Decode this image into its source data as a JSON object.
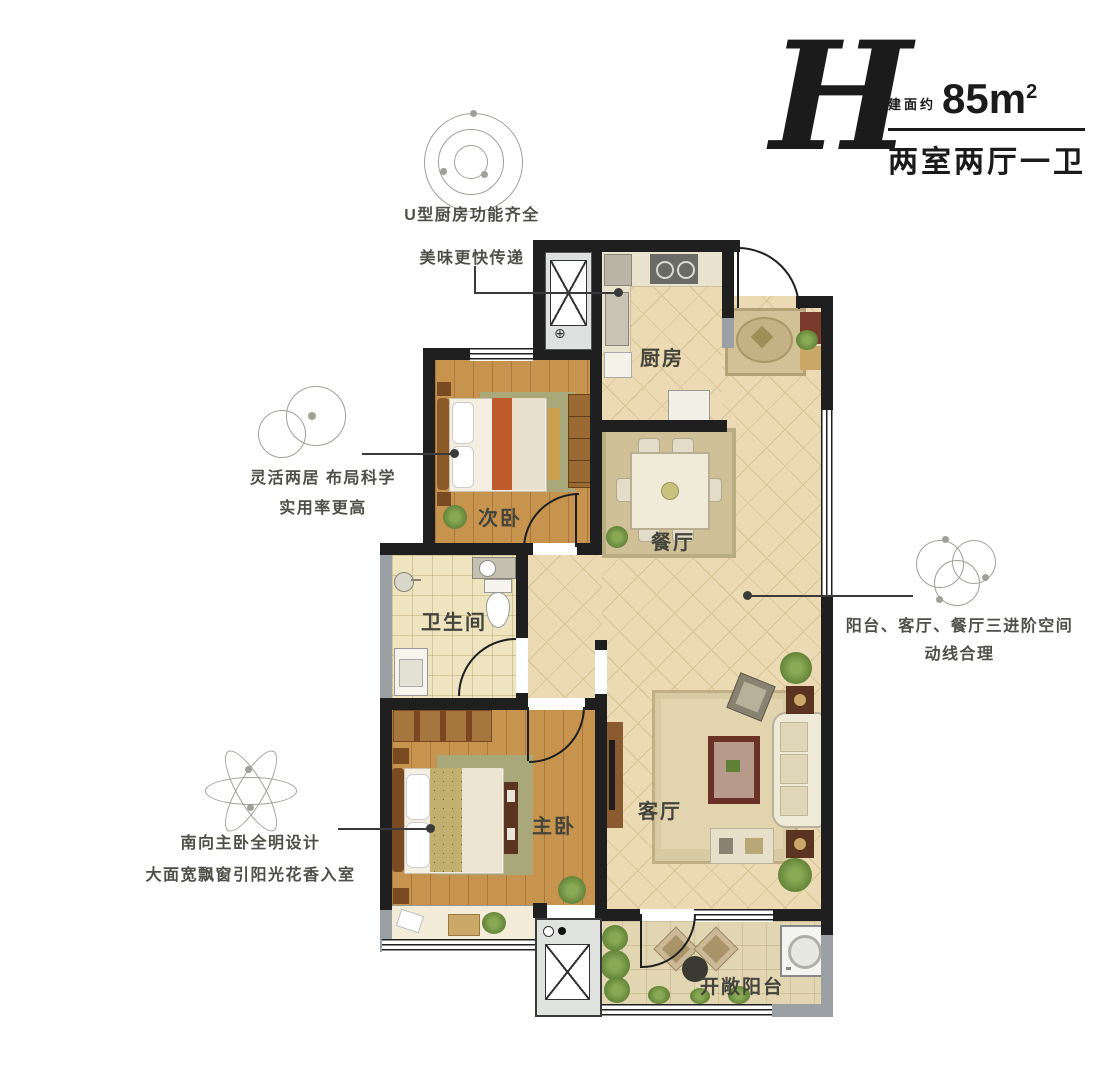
{
  "title_block": {
    "letter": "H",
    "area_prefix": "建面约",
    "area_value": "85m",
    "area_sup": "2",
    "layout_desc": "两室两厅一卫"
  },
  "annotations": {
    "kitchen": {
      "line1": "U型厨房功能齐全",
      "line2": "美味更快传递"
    },
    "flexible": {
      "line1": "灵活两居 布局科学",
      "line2": "实用率更高"
    },
    "flow": {
      "line1": "阳台、客厅、餐厅三进阶空间",
      "line2": "动线合理"
    },
    "master": {
      "line1": "南向主卧全明设计",
      "line2": "大面宽飘窗引阳光花香入室"
    }
  },
  "rooms": {
    "kitchen": "厨房",
    "second_bedroom": "次卧",
    "dining": "餐厅",
    "bathroom": "卫生间",
    "master_bedroom": "主卧",
    "living_room": "客厅",
    "balcony": "开敞阳台"
  },
  "icons": {
    "compass": "⊕"
  },
  "colors": {
    "wall": "#1f1f1f",
    "graywall": "#9aa0a3",
    "tile": "#ebdab3",
    "tileline": "#d8c495",
    "wood": "#c6944f",
    "bath": "#eee4bf",
    "balcony": "#e2d6b2",
    "rug": "#a9a87b",
    "livrug": "#d8caa2",
    "plantd": "#5f8136",
    "plantl": "#8aa956",
    "leader": "#3a3a3a",
    "motif": "#a0a099",
    "label": "#44443c",
    "ann": "#4f4f49",
    "title": "#1b1b1b",
    "shaft": "#dfe1e0",
    "accent": "#bf5a2c"
  }
}
